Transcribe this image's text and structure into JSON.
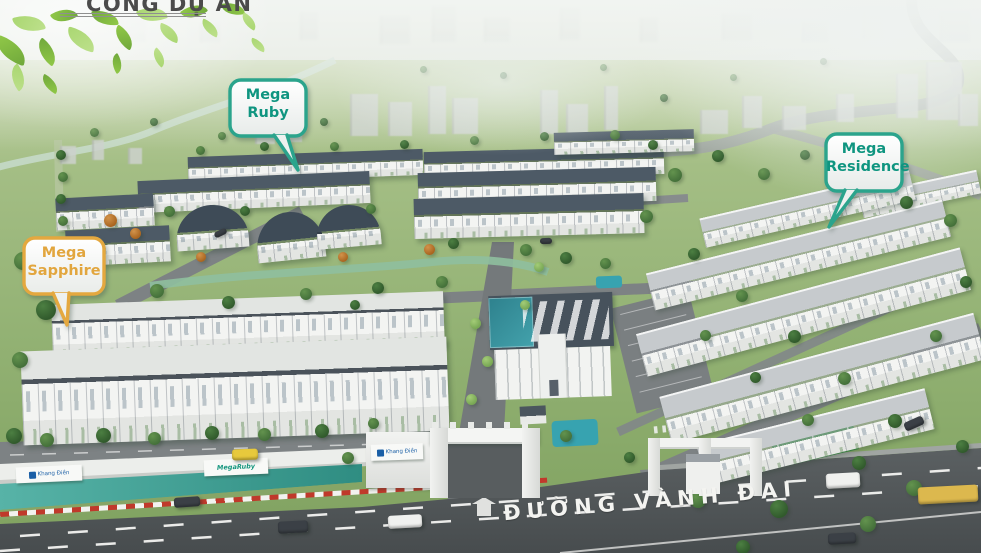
{
  "header": {
    "title": "CỔNG DỰ ÁN"
  },
  "callouts": {
    "ruby": {
      "line1": "Mega",
      "line2": "Ruby"
    },
    "sapphire": {
      "line1": "Mega",
      "line2": "Sapphire"
    },
    "residence": {
      "line1": "Mega",
      "line2": "Residence"
    }
  },
  "road_label": "ĐƯỜNG VÀNH ĐAI",
  "billboards": {
    "left": "Khang Điền",
    "right": "MegaRuby",
    "gate": "Khang Điền"
  },
  "colors": {
    "callout_teal_border": "#2ba48c",
    "callout_teal_text": "#0f9580",
    "callout_gold_border": "#e4a83f",
    "callout_gold_text": "#e2a63e",
    "water_teal": "#37a3b0",
    "road_text": "#f4f4f1",
    "header_text": "#4b4b4b"
  }
}
